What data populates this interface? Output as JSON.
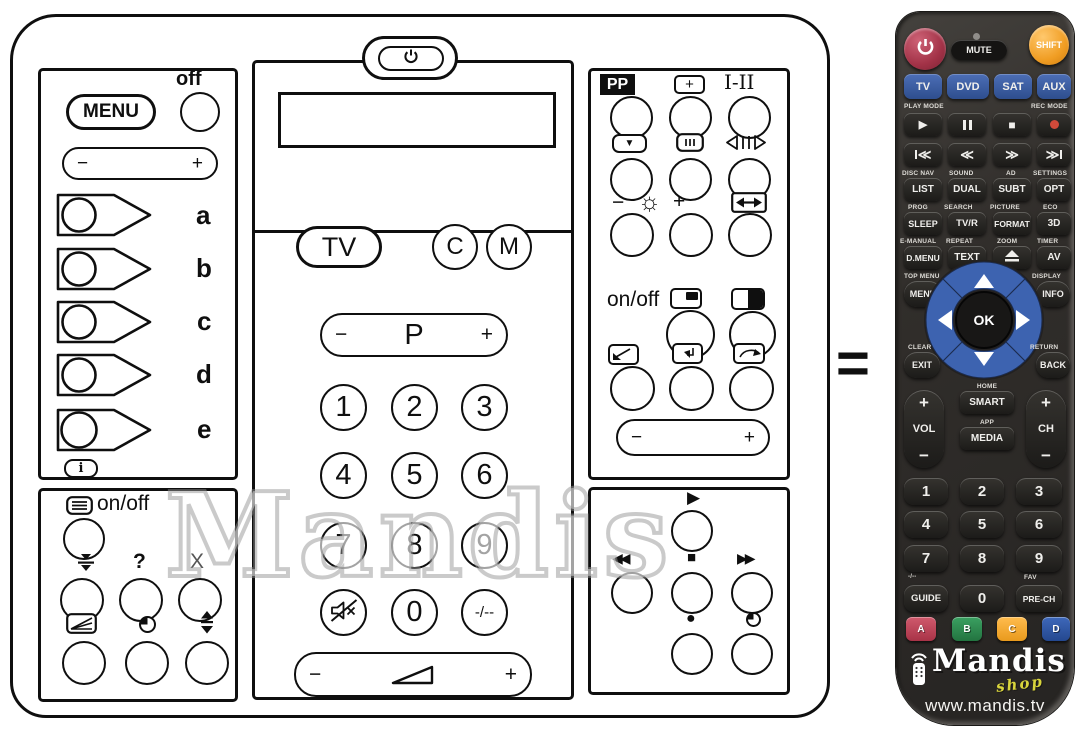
{
  "watermark": "Mandis",
  "equals": "=",
  "g": {
    "minus": "−",
    "plus": "+"
  },
  "original": {
    "left": {
      "off": "off",
      "menu": "MENU",
      "keys": [
        "a",
        "b",
        "c",
        "d",
        "e"
      ],
      "info": "i",
      "text_onoff": "on/off",
      "help": "?",
      "cancel": "X"
    },
    "center": {
      "tv": "TV",
      "c": "C",
      "m": "M",
      "p": "P",
      "digits": [
        "1",
        "2",
        "3",
        "4",
        "5",
        "6",
        "7",
        "8",
        "9"
      ],
      "zero": "0",
      "dashes": "-/--"
    },
    "right": {
      "pp": "PP",
      "plus_box": "+",
      "dual": "I-II",
      "sun": "☼",
      "onoff": "on/off",
      "still": "▼",
      "play": "▶",
      "rew": "◀◀",
      "stop": "■",
      "ff": "▶▶",
      "rec": "●"
    }
  },
  "replacement": {
    "mute": "MUTE",
    "shift": "SHIFT",
    "devices": [
      "TV",
      "DVD",
      "SAT",
      "AUX"
    ],
    "play_mode": "PLAY MODE",
    "rec_mode": "REC MODE",
    "icons": {
      "play": "▶",
      "stop": "■",
      "rewind": "≪",
      "forward": "≫"
    },
    "rows": {
      "labels1": [
        "DISC NAV",
        "SOUND",
        "AD",
        "SETTINGS"
      ],
      "keys1": [
        "LIST",
        "DUAL",
        "SUBT",
        "OPT"
      ],
      "labels2": [
        "PROG",
        "SEARCH",
        "PICTURE",
        "ECO"
      ],
      "keys2": [
        "SLEEP",
        "TV/R",
        "FORMAT",
        "3D"
      ],
      "labels3": [
        "E-MANUAL",
        "REPEAT",
        "ZOOM",
        "TIMER"
      ],
      "keys3": [
        "D.MENU",
        "TEXT",
        "AV"
      ]
    },
    "top_menu": "TOP MENU",
    "display": "DISPLAY",
    "menu": "MENU",
    "info": "INFO",
    "ok": "OK",
    "clear": "CLEAR",
    "return": "RETURN",
    "exit": "EXIT",
    "back": "BACK",
    "home": "HOME",
    "smart": "SMART",
    "app": "APP",
    "media": "MEDIA",
    "vol": "VOL",
    "ch": "CH",
    "digits": [
      "1",
      "2",
      "3",
      "4",
      "5",
      "6",
      "7",
      "8",
      "9"
    ],
    "zero": "0",
    "guide": "GUIDE",
    "prech": "PRE-CH",
    "fav": "FAV",
    "dashes": "-/--",
    "color_keys": [
      "A",
      "B",
      "C",
      "D"
    ],
    "brand": "Mandis",
    "shop": "shop",
    "url": "www.mandis.tv",
    "colors": {
      "power_red": "#a93b4f",
      "shift_orange": "#f2a135",
      "device_blue": "#3c5fa7",
      "dpad_blue": "#3d63b0",
      "record_red": "#d04a3a",
      "key_a": "#c24055",
      "key_b": "#2f8a4d",
      "key_c": "#f3a52c",
      "key_d": "#2d57ab"
    }
  }
}
